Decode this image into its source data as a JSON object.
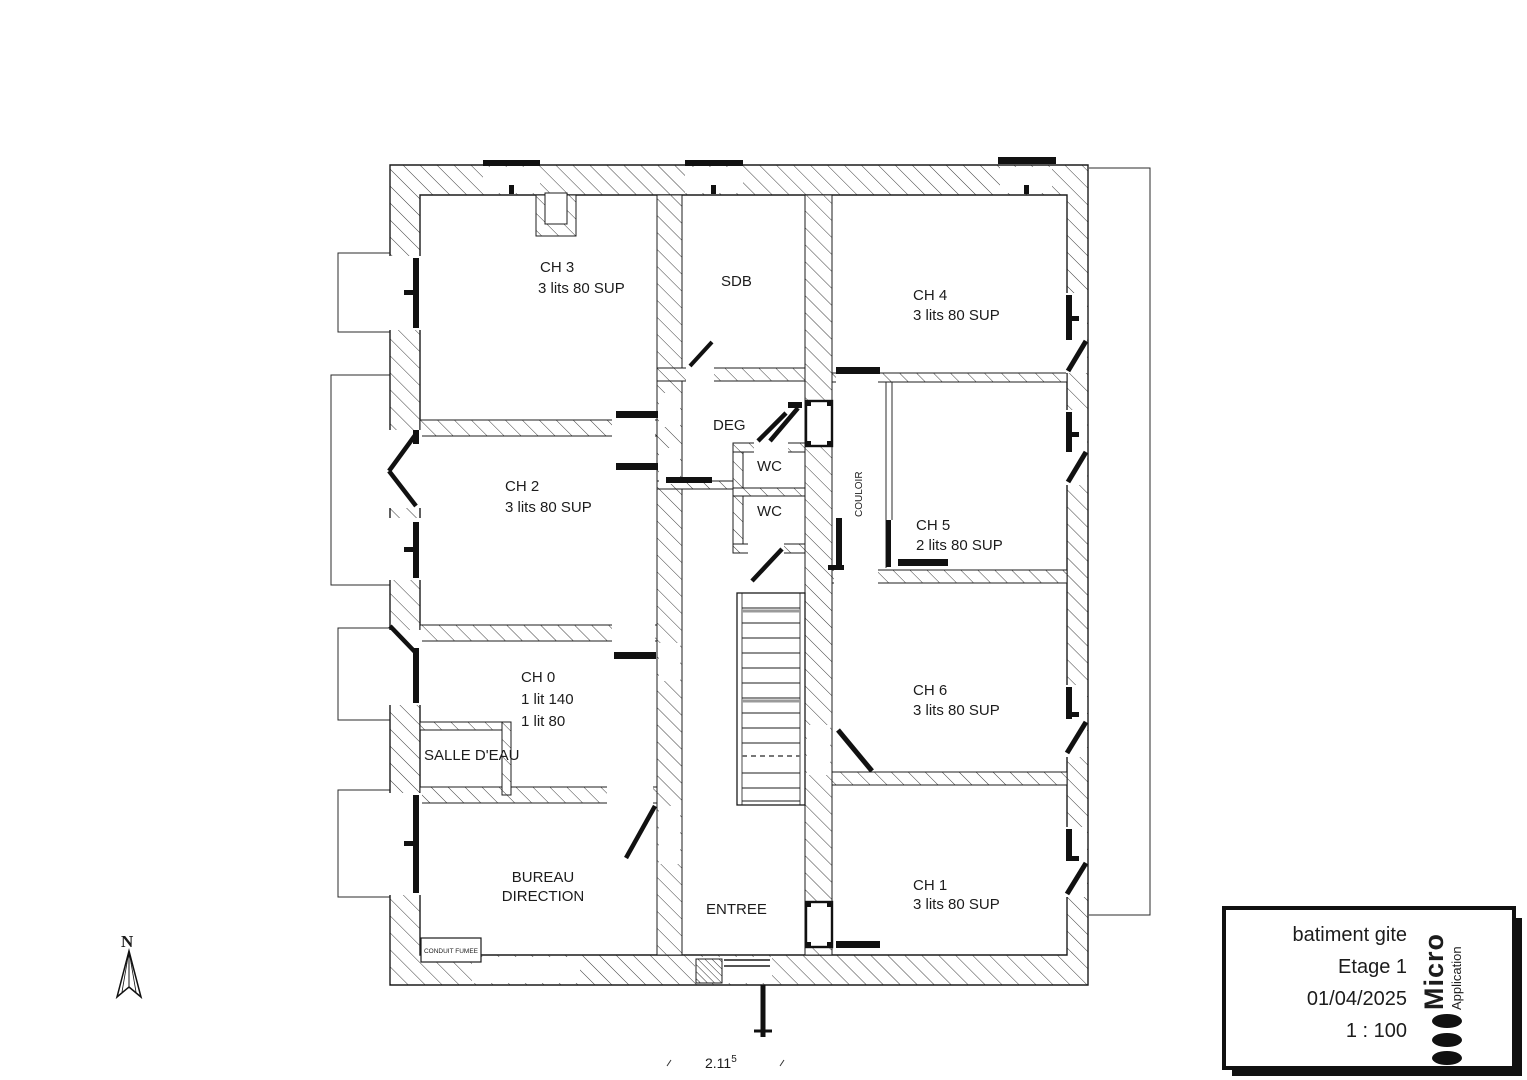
{
  "plan": {
    "rooms": {
      "ch3": {
        "label": "CH 3",
        "beds": "3 lits 80 SUP"
      },
      "sdb": {
        "label": "SDB"
      },
      "ch4": {
        "label": "CH 4",
        "beds": "3 lits 80 SUP"
      },
      "ch2": {
        "label": "CH 2",
        "beds": "3 lits 80 SUP"
      },
      "deg": {
        "label": "DEG"
      },
      "wc_north": {
        "label": "WC"
      },
      "wc_south": {
        "label": "WC"
      },
      "couloir": {
        "label": "COULOIR"
      },
      "ch5": {
        "label": "CH 5",
        "beds": "2 lits 80 SUP"
      },
      "ch0": {
        "label": "CH 0",
        "beds": "1 lit 140",
        "beds2": "1 lit 80"
      },
      "salle_eau": {
        "label": "SALLE D'EAU"
      },
      "ch6": {
        "label": "CH 6",
        "beds": "3 lits 80 SUP"
      },
      "bureau": {
        "label": "BUREAU",
        "label2": "DIRECTION"
      },
      "entree": {
        "label": "ENTREE"
      },
      "ch1": {
        "label": "CH 1",
        "beds": "3 lits 80 SUP"
      },
      "conduit_fumee": {
        "label": "CONDUIT FUMEE"
      }
    },
    "compass": {
      "label": "N"
    },
    "dimension": {
      "value": "2.11",
      "exponent": "5"
    }
  },
  "title_block": {
    "project": "batiment gite",
    "sheet": "Etage 1",
    "date": "01/04/2025",
    "scale": "1 : 100",
    "brand": {
      "name": "Micro",
      "sub": "Application"
    }
  },
  "colors": {
    "line": "#1c1c1c",
    "paper": "#ffffff"
  }
}
